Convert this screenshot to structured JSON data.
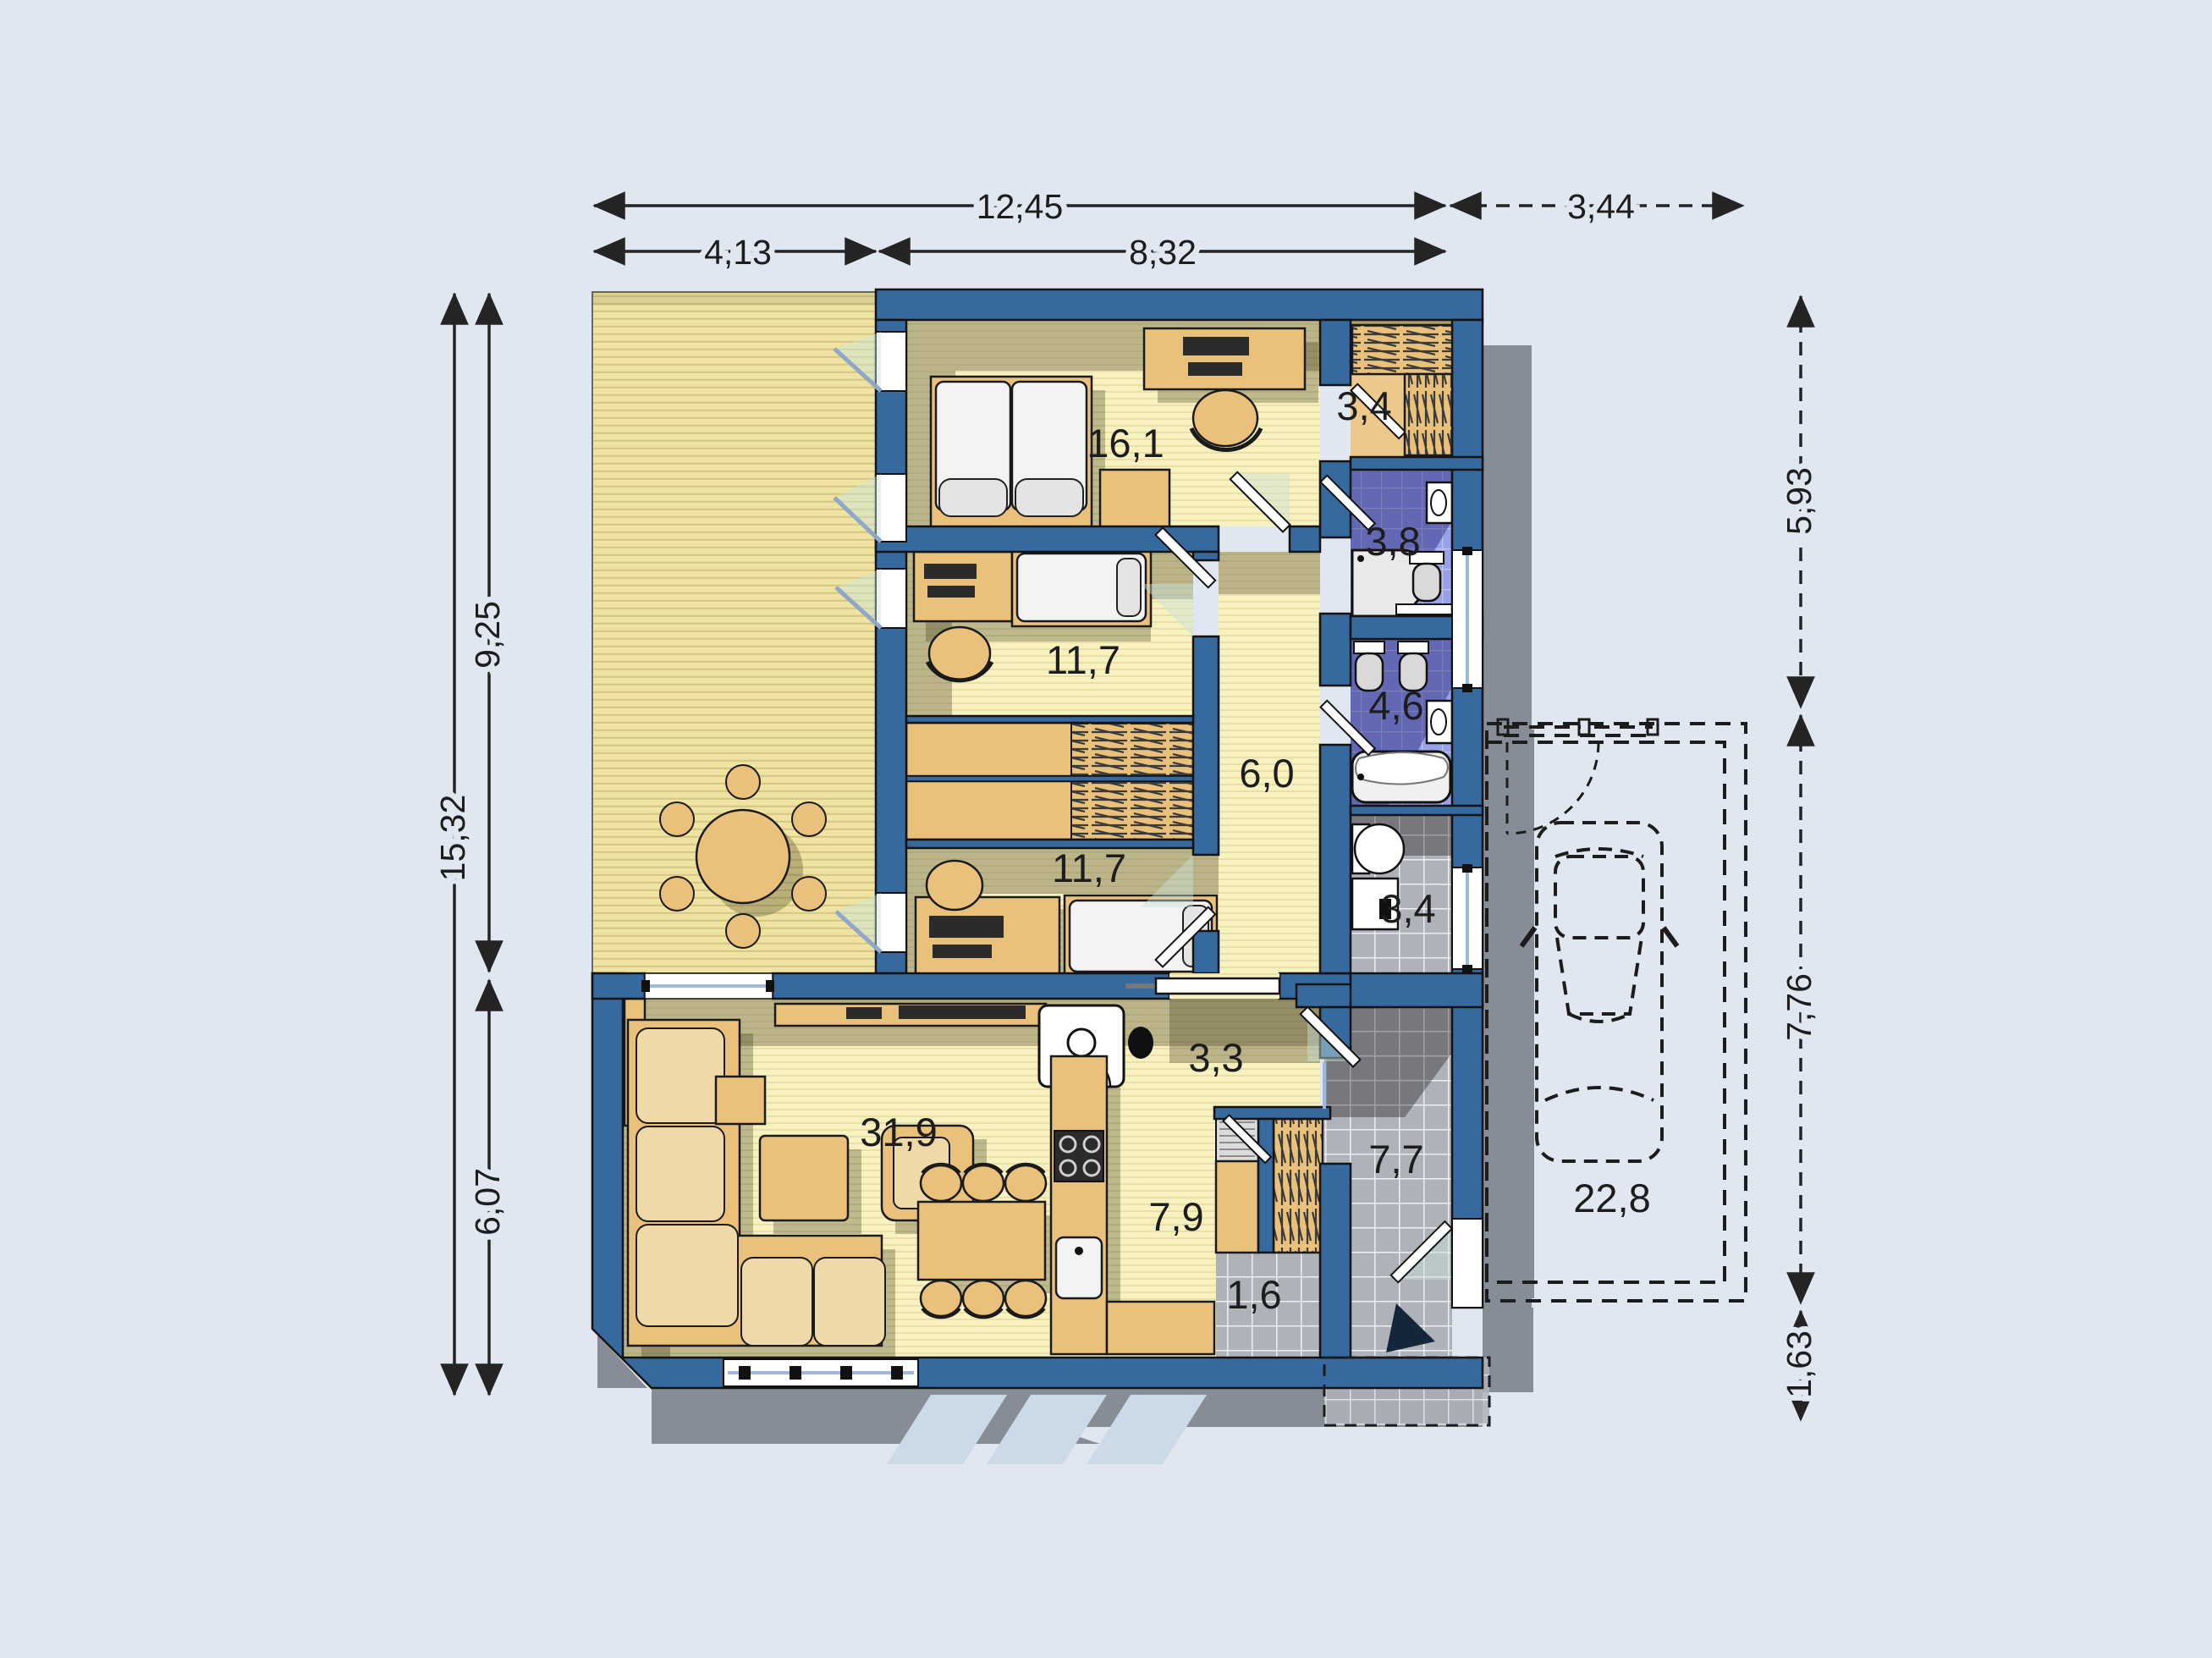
{
  "plan_title": "single-storey house floor plan with carport",
  "rooms": [
    {
      "name": "bedroom-1",
      "area": "16,1"
    },
    {
      "name": "wardrobe-closet",
      "area": "3,4"
    },
    {
      "name": "bathroom",
      "area": "3,8"
    },
    {
      "name": "bedroom-2",
      "area": "11,7"
    },
    {
      "name": "wc",
      "area": "4,6"
    },
    {
      "name": "closet-hall",
      "area": "6,0"
    },
    {
      "name": "bedroom-3",
      "area": "11,7"
    },
    {
      "name": "utility-room",
      "area": "3,4"
    },
    {
      "name": "hallway",
      "area": "3,3"
    },
    {
      "name": "living-room",
      "area": "31,9"
    },
    {
      "name": "kitchen",
      "area": "7,9"
    },
    {
      "name": "entry-hall",
      "area": "7,7"
    },
    {
      "name": "pantry",
      "area": "1,6"
    },
    {
      "name": "garage",
      "area": "22,8"
    }
  ],
  "dimensions": {
    "top": [
      {
        "name": "overall-width",
        "label": "12,45"
      },
      {
        "name": "terrace-width",
        "label": "4,13"
      },
      {
        "name": "house-width",
        "label": "8,32"
      },
      {
        "name": "carport-width",
        "label": "3,44"
      }
    ],
    "left": [
      {
        "name": "upper-depth",
        "label": "9,25"
      },
      {
        "name": "overall-depth",
        "label": "15,32"
      },
      {
        "name": "living-depth",
        "label": "6,07"
      }
    ],
    "right": [
      {
        "name": "north-wing-depth",
        "label": "5,93"
      },
      {
        "name": "carport-depth",
        "label": "7,76"
      },
      {
        "name": "porch-depth",
        "label": "1,63"
      }
    ]
  },
  "colors": {
    "background": "#e1e7f0",
    "wall": "#36699e",
    "floor_wood": "#f8f1c0",
    "terrace_deck": "#efe3a2",
    "tile_blue": "#98a2e6",
    "tile_gray": "#b3b5bc",
    "furniture_wood": "#eac17b",
    "shadow_outside": "#878d96",
    "dimension_text": "#1d1d1d"
  }
}
